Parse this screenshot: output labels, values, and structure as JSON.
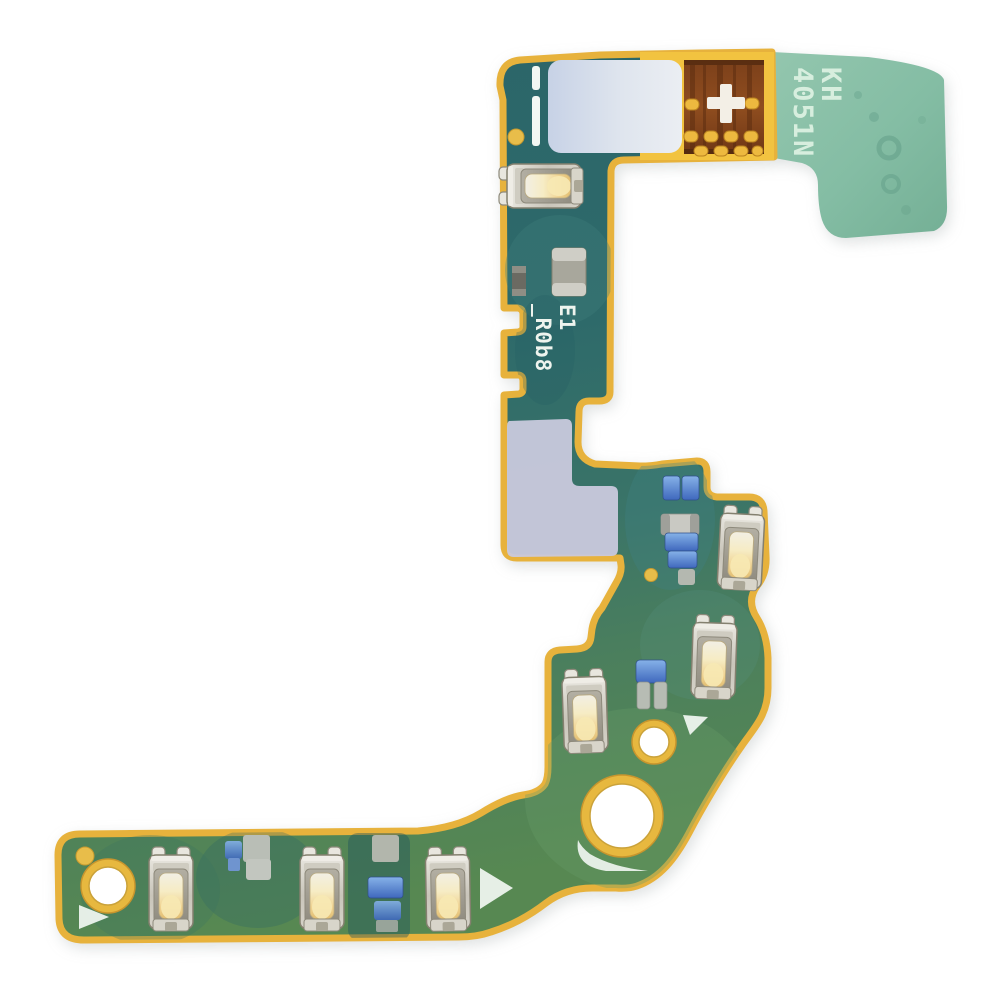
{
  "scene": {
    "description": "Photo of a green PCB signal antenna flex cable module on a white background",
    "background_color": "#ffffff"
  },
  "markings": {
    "tab_text_line1": "KH",
    "tab_text_line2": "4051N",
    "board_text_line1": "E1",
    "board_text_line2": "_R0b8",
    "polarity_mark": "+"
  },
  "board": {
    "substrate_teal": "#2d686b",
    "substrate_green": "#55864f",
    "edge_plating_gold": "#e7b23c",
    "flex_coverlay_yellow": "#f2c340",
    "copper_contact_brown": "#8a4a20",
    "flex_tab_mint": "#84bda4",
    "sticker_top": "#ccd6e8",
    "sticker_bend": "#c9c9dd",
    "silkscreen_white": "#f2f7f3",
    "contact_clip_silver": "#d6d3c9",
    "contact_clip_gold_center": "#f0d494",
    "smd_blue": "#4a7fd0",
    "smd_gray": "#b9beb6"
  },
  "features": {
    "contact_clip_count": 7,
    "mounting_hole_count": 3,
    "fiducial_dot_count": 3,
    "orientation_triangle_count": 3,
    "gold_pad_rows": [
      2,
      4,
      4
    ]
  }
}
